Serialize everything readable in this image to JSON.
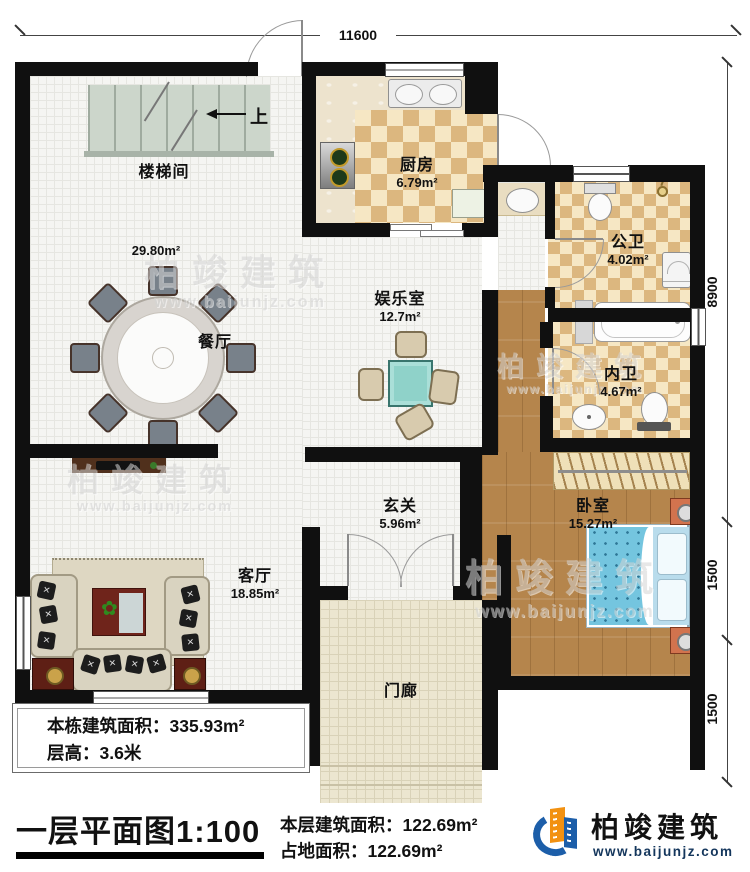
{
  "title": {
    "plan_title": "一层平面图1:100"
  },
  "dimensions": {
    "top": "11600",
    "right_segments": [
      "8900",
      "1500",
      "1500"
    ]
  },
  "stairs": {
    "up_label": "上"
  },
  "rooms": {
    "stairwell": {
      "name": "楼梯间"
    },
    "dining": {
      "name": "餐厅",
      "area": "29.80m²"
    },
    "kitchen": {
      "name": "厨房",
      "area": "6.79m²"
    },
    "public_bath": {
      "name": "公卫",
      "area": "4.02m²"
    },
    "inner_bath": {
      "name": "内卫",
      "area": "4.67m²"
    },
    "game_room": {
      "name": "娱乐室",
      "area": "12.7m²"
    },
    "foyer": {
      "name": "玄关",
      "area": "5.96m²"
    },
    "bedroom": {
      "name": "卧室",
      "area": "15.27m²"
    },
    "living_room": {
      "name": "客厅",
      "area": "18.85m²"
    },
    "porch": {
      "name": "门廊"
    }
  },
  "stats": {
    "building_total_area": "本栋建筑面积：335.93m²",
    "floor_height": "层高：3.6米",
    "floor_area": "本层建筑面积：122.69m²",
    "footprint_area": "占地面积：122.69m²"
  },
  "brand": {
    "name": "柏竣建筑",
    "website": "www.baijunjz.com"
  },
  "watermark": {
    "text": "柏竣建筑",
    "website": "www.baijunjz.com"
  },
  "colors": {
    "wall": "#101010",
    "checker_tan": "#dcb77f",
    "wood": "#b5854c",
    "brand_blue": "#1c5ea9",
    "brand_orange": "#f29111"
  }
}
